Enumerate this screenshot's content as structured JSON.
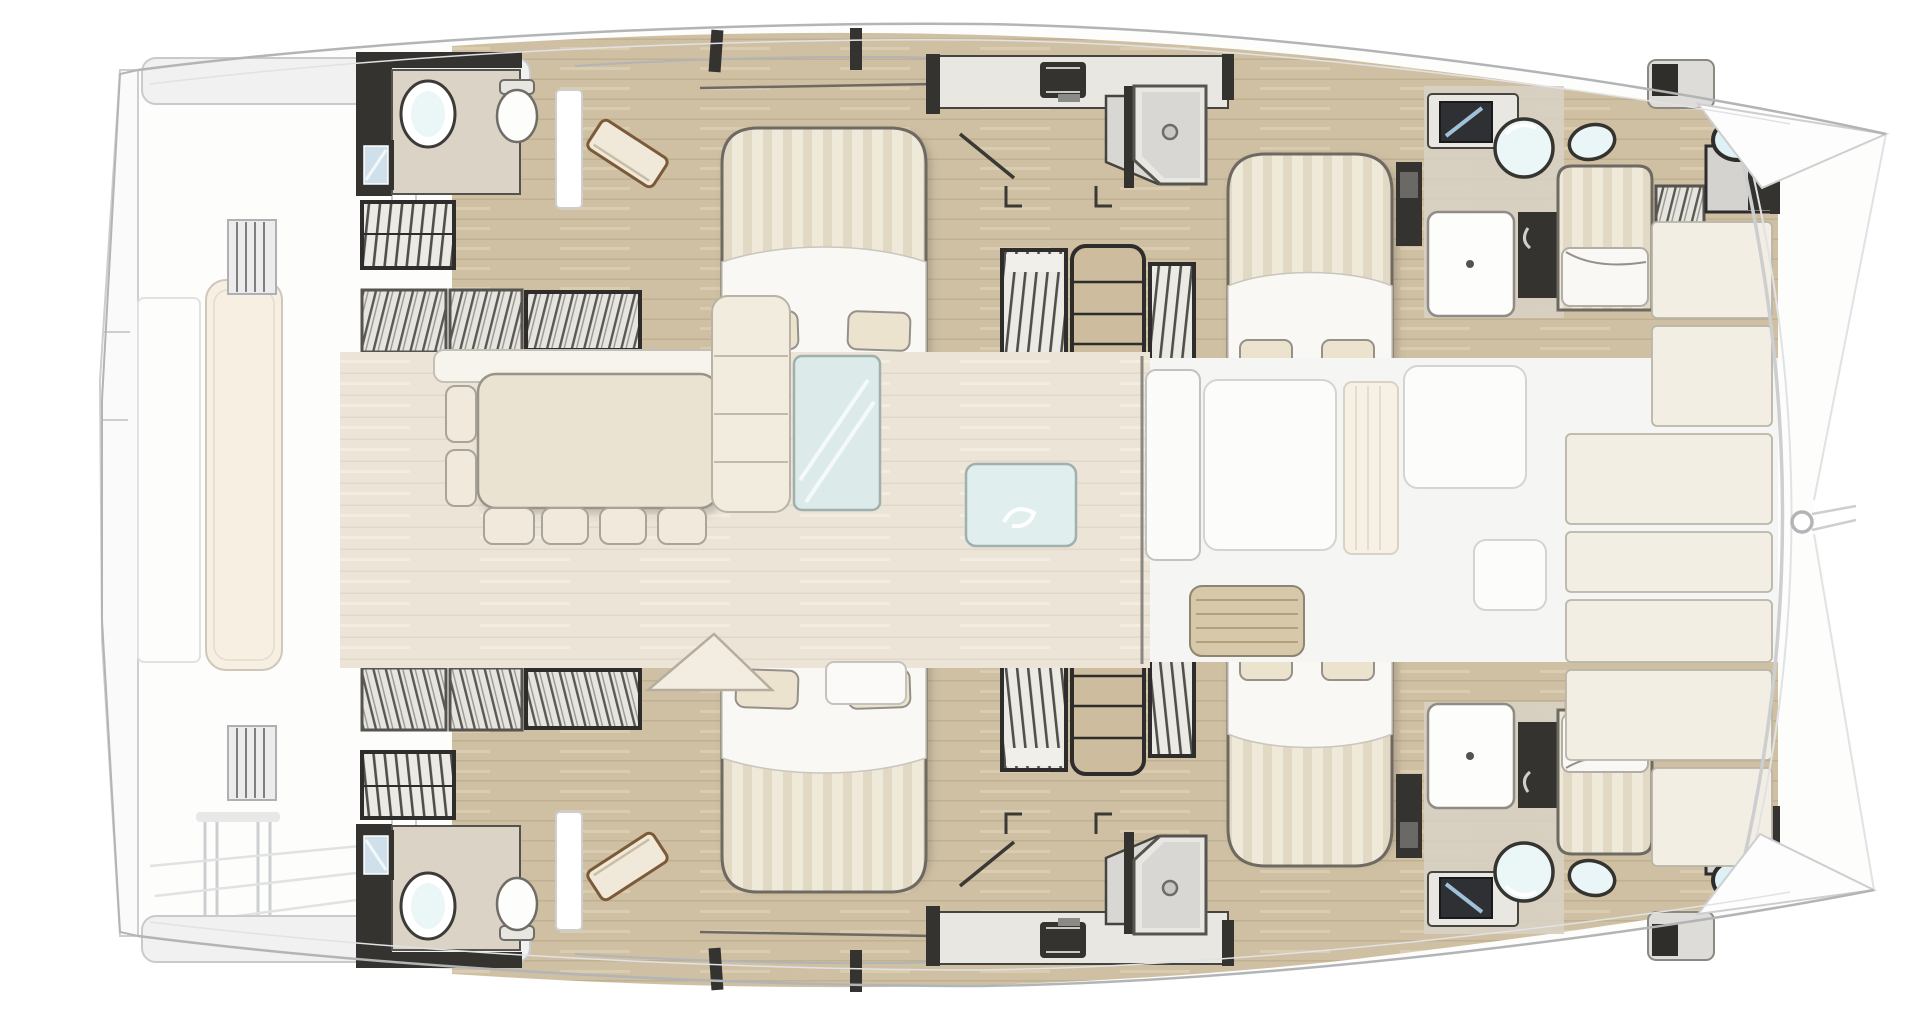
{
  "meta": {
    "image_kind": "yacht-floor-plan-illustration",
    "view": "top-down deck and accommodation plan",
    "vessel_type": "sailing-catamaran",
    "orientation": "bow-right-stern-left",
    "visible_text": ""
  },
  "inventory": {
    "double_beds": 4,
    "single_beds": 2,
    "heads_bathrooms": 4,
    "showers": 2,
    "dinette_table": 1,
    "dinette_chairs": 6,
    "wardrobes": 8,
    "companionway_stairs": 4,
    "galley_sinks": 2,
    "washbasins": 6,
    "bow_portholes": 2,
    "foredeck_sunpads": 7,
    "aft_cockpit_benches": 1
  },
  "colors": {
    "paper": "#ffffff",
    "hull_fill": "#fdfdfc",
    "line_mid": "#b2b4b6",
    "line_faint": "#cdced0",
    "line_lighter": "#e1e2e4",
    "wood": "#cfc0a3",
    "wood_line": "#b3a383",
    "wood_hi": "#dccfb4",
    "salon": "#ece4d7",
    "salon_line": "#ded5c5",
    "cream_panel": "#f3eee3",
    "panel_line": "#bab5a9",
    "fore_white": "#f5f5f3",
    "white_soft": "#fcfcfb",
    "white_line": "#d4d4d1",
    "dark": "#35332f",
    "frame": "#2e2d2b",
    "frame_mid": "#56544e",
    "gray_fill": "#e9e7e2",
    "gray_mid": "#d8d7d3",
    "counter": "#dbd3c5",
    "counter_line": "#55534d",
    "matt_base": "#efe9da",
    "matt_stripe": "#dcd1b8",
    "duvet": "#f9f8f4",
    "duvet_line": "#c9c6bd",
    "pillow": "#ece3cf",
    "pillow_line": "#95908a",
    "bed_line": "#6e6a62",
    "sofa": "#f2ecdf",
    "sofa_line": "#b9b3a6",
    "tbl": "#ebe3d2",
    "tbl_line": "#99948a",
    "chair": "#f0e9dc",
    "chair_line": "#a9a499",
    "glass": "#dcebea",
    "glass_line": "#9fb0ae",
    "glass_hi": "#f4fafa",
    "sink": "#ebf6f7",
    "tan_bench": "#d8c8aa",
    "tan_line": "#8d8572",
    "shelf_tan": "#cdbd9e",
    "step_bg": "#eceae4",
    "hatch_bg": "#e7e5e0",
    "cushion": "#f6efe2",
    "cushion_line": "#cfc8ba"
  }
}
